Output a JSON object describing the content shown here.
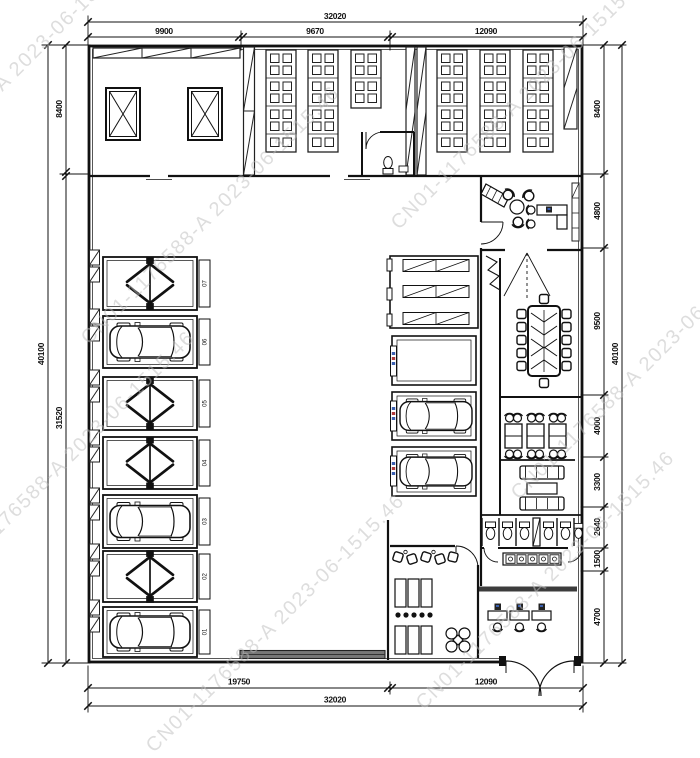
{
  "dimensions": {
    "top": {
      "total": "32020",
      "segments": [
        "9900",
        "9670",
        "12090"
      ]
    },
    "bottom": {
      "total": "32020",
      "segments": [
        "19750",
        "12090"
      ]
    },
    "left": {
      "total": "40100",
      "segments": [
        "8400",
        "31520"
      ]
    },
    "right": {
      "total": "40100",
      "segments": [
        "8400",
        "4800",
        "9500",
        "4000",
        "3300",
        "2640",
        "1500",
        "4700"
      ]
    }
  },
  "bays": [
    {
      "label": "07",
      "type": "lift"
    },
    {
      "label": "06",
      "type": "car"
    },
    {
      "label": "05",
      "type": "lift"
    },
    {
      "label": "04",
      "type": "lift"
    },
    {
      "label": "03",
      "type": "car"
    },
    {
      "label": "02",
      "type": "lift"
    },
    {
      "label": "01",
      "type": "car"
    }
  ],
  "watermark": {
    "text": "CN01-1176588-A 2023-06-1515.46"
  },
  "colors": {
    "line": "#1a1a1a",
    "watermark": "#bdbdbd",
    "rolling_door": "#777777",
    "thick_wall": "#3c3c3c",
    "accent_blue": "#3a5fb0",
    "accent_red": "#b03a3a"
  }
}
